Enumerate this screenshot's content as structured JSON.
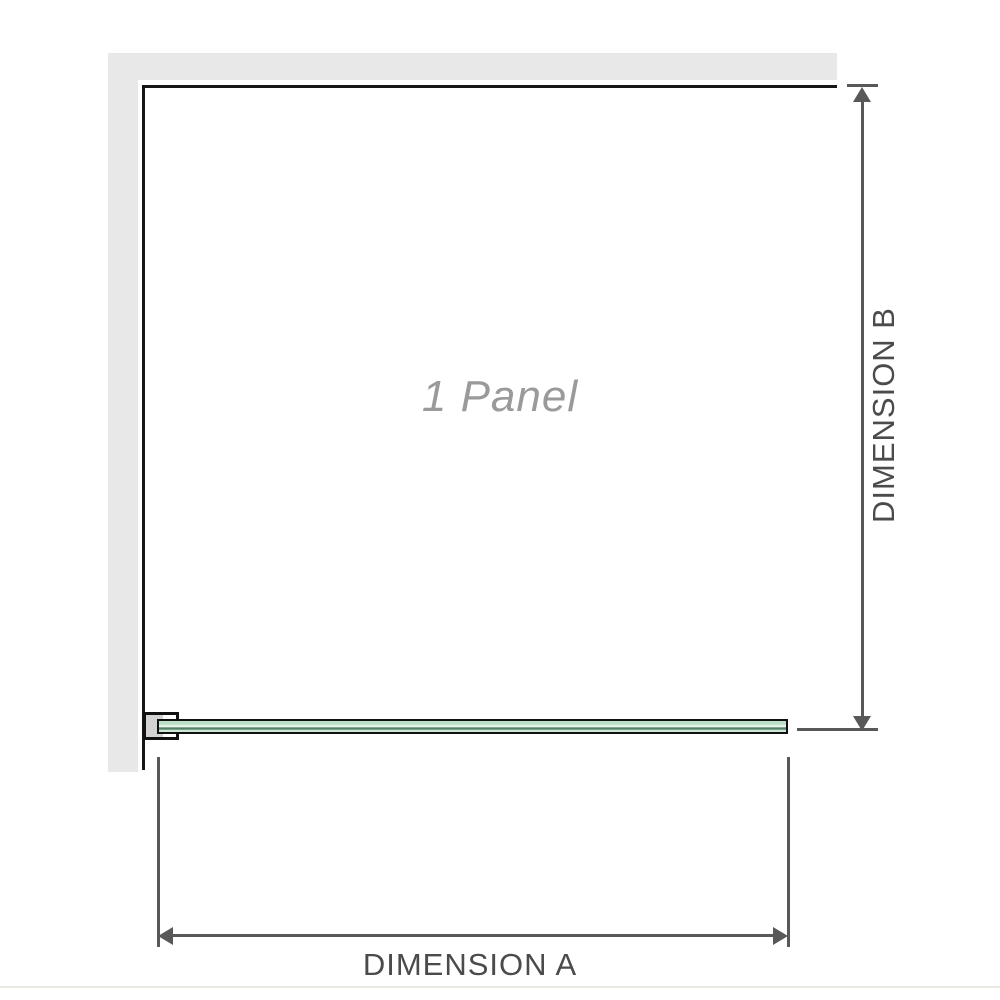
{
  "diagram": {
    "title": "1 Panel",
    "dimensions": {
      "a_label": "DIMENSION A",
      "b_label": "DIMENSION B"
    },
    "colors": {
      "bg": "#ffffff",
      "wall": "#e8e8e8",
      "panel_outline": "#161616",
      "panel_text": "#9a9a9a",
      "dimension_line": "#58585a",
      "dimension_text": "#4b4b4d",
      "glass_outline": "#111111",
      "glass_light": "#b9dfc6",
      "glass_light2": "#cde9d6",
      "glass_highlight": "#e9f5ec",
      "glass_stripe": "#55806b",
      "bracket_fill": "#d3d3d3",
      "footer_line": "#ece9e2"
    }
  }
}
